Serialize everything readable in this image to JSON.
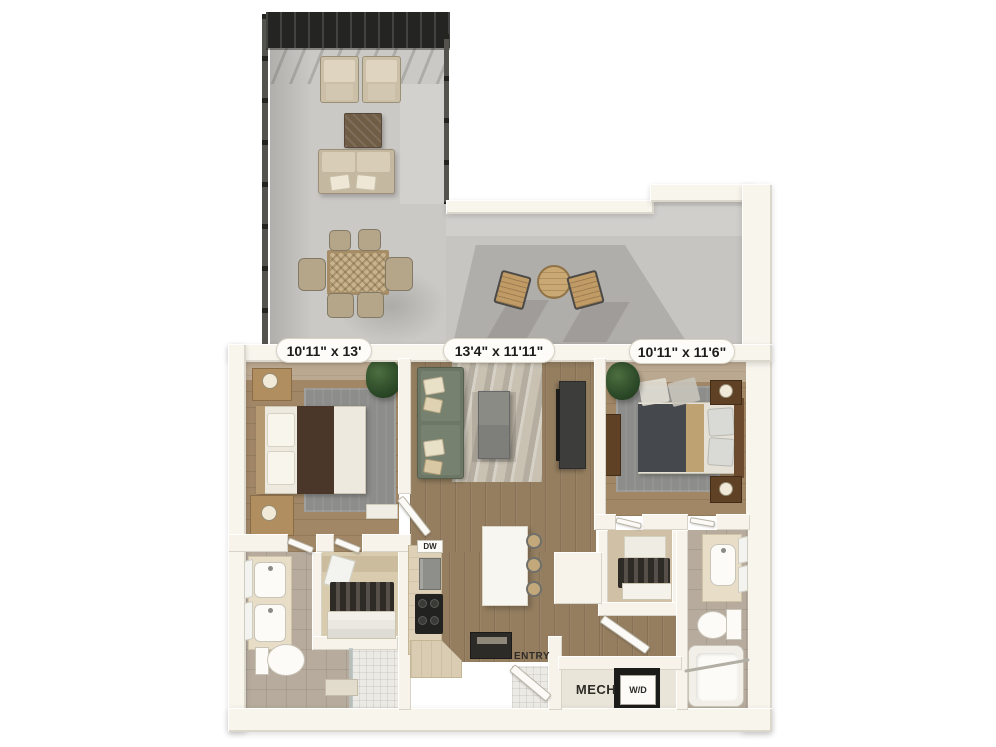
{
  "floorplan": {
    "view": "3d-top-down-floorplan",
    "background_color": "#ffffff",
    "dimension_labels": [
      {
        "room": "bedroom-1",
        "text": "10'11\" x 13'"
      },
      {
        "room": "living-room",
        "text": "13'4\" x 11'11\""
      },
      {
        "room": "bedroom-2",
        "text": "10'11\" x 11'6\""
      }
    ],
    "room_tags": {
      "dishwasher": "DW",
      "entry": "ENTRY",
      "mechanical": "MECH",
      "washer_dryer": "W/D"
    },
    "colors": {
      "wall": "#f7f3ea",
      "wall_shade": "#ddd5c2",
      "terrace_floor": "#cbc9c5",
      "terrace_shadow": "#b2b0ac",
      "pergola": "#242422",
      "wood_floor": "#9a8164",
      "wood_floor_light": "#c2a87f",
      "tile_floor": "#b6ab9d",
      "shower_tile": "#eceae5",
      "rug_gray": "#8d8d8b",
      "rug_beige": "#c9c2b3",
      "sofa_green": "#6d7766",
      "bed_charcoal": "#45484c",
      "bed_brown": "#4a3729",
      "accent_tan": "#bfa271",
      "counter_wood": "#ded1b7",
      "appliance_black": "#222220",
      "label_text": "#1c1c1a"
    }
  }
}
